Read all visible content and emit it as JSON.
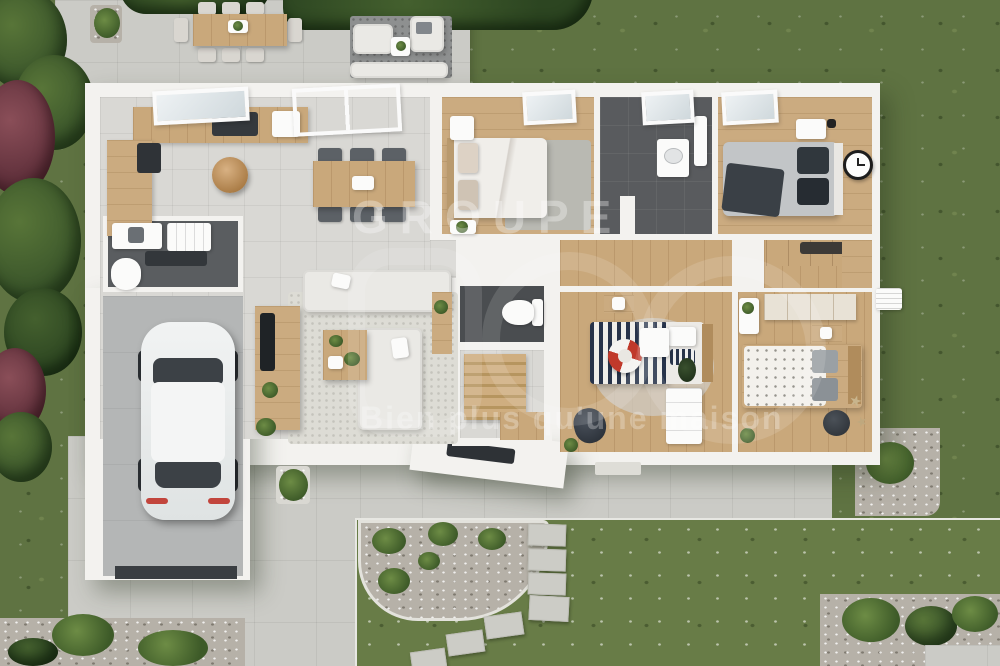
{
  "watermark": {
    "brand_prefix": "GROUPE",
    "tagline": "Bien plus qu'une maison"
  },
  "scene": {
    "type": "3d-floor-plan-render",
    "view": "top-down aerial of single-storey house with garden",
    "rooms": [
      {
        "name": "terrace",
        "furniture": [
          "outdoor-dining-table",
          "eight-chairs",
          "lounge-sofa-set",
          "round-side-table",
          "outdoor-rug",
          "planters"
        ]
      },
      {
        "name": "kitchen-dining-living",
        "furniture": [
          "l-shaped-kitchen-counter",
          "cooktop",
          "rattan-pendant-lamps",
          "dining-table-6-chairs",
          "two-sofas",
          "coffee-table",
          "tv-sideboard",
          "rug",
          "skylight-windows"
        ]
      },
      {
        "name": "utility-room",
        "furniture": [
          "washing-machine",
          "cabinet",
          "counter",
          "water-heater"
        ]
      },
      {
        "name": "garage",
        "furniture": [
          "white-car"
        ]
      },
      {
        "name": "wc",
        "furniture": [
          "toilet",
          "console-table"
        ]
      },
      {
        "name": "staircase",
        "furniture": [
          "wooden-steps",
          "landing"
        ]
      },
      {
        "name": "bedroom-1",
        "furniture": [
          "double-bed-white-linen",
          "round-nightstand",
          "nightstand-plant",
          "grey-rug",
          "skylight"
        ]
      },
      {
        "name": "bathroom",
        "furniture": [
          "vanity-basin",
          "mirror",
          "dark-tile-floor",
          "skylight"
        ]
      },
      {
        "name": "bedroom-2-master",
        "furniture": [
          "double-bed-grey-linen",
          "nightstand",
          "wall-clock",
          "wall-lamp",
          "skylight"
        ]
      },
      {
        "name": "dressing-room",
        "furniture": [
          "wardrobe-units"
        ]
      },
      {
        "name": "bedroom-3",
        "furniture": [
          "bed-dotted-duvet",
          "wood-headboard",
          "nightstand-lamp",
          "pouf",
          "starfish-decor",
          "wardrobe"
        ]
      },
      {
        "name": "bedroom-4-marine",
        "furniture": [
          "navy-striped-bed",
          "lifebuoy-decor",
          "round-table",
          "white-wardrobe",
          "beanbag",
          "round-rug",
          "nightstand-lamp"
        ]
      }
    ],
    "exterior": [
      "lawn-with-daisies",
      "stepping-stone-path",
      "curved-gravel-bed",
      "hedges",
      "purple-trees",
      "driveway",
      "gravel-borders",
      "fern-bed",
      "palm-planter",
      "doormat"
    ],
    "vehicle": "white hatchback parked in garage"
  },
  "palette": {
    "grass": "#5f7342",
    "lawn": "#687c47",
    "hedge": "#2c4521",
    "purple_tree": "#6e3a44",
    "concrete": "#cbcbc6",
    "wall": "#f3f2ef",
    "interior_tile": "#d9d8d4",
    "wood_floor": "#c9a87b",
    "dark_tile": "#4a4d50",
    "navy_stripe": "#27334a",
    "lifebuoy_red": "#c0392b",
    "watermark_white": "rgba(255,255,255,0.32)"
  }
}
